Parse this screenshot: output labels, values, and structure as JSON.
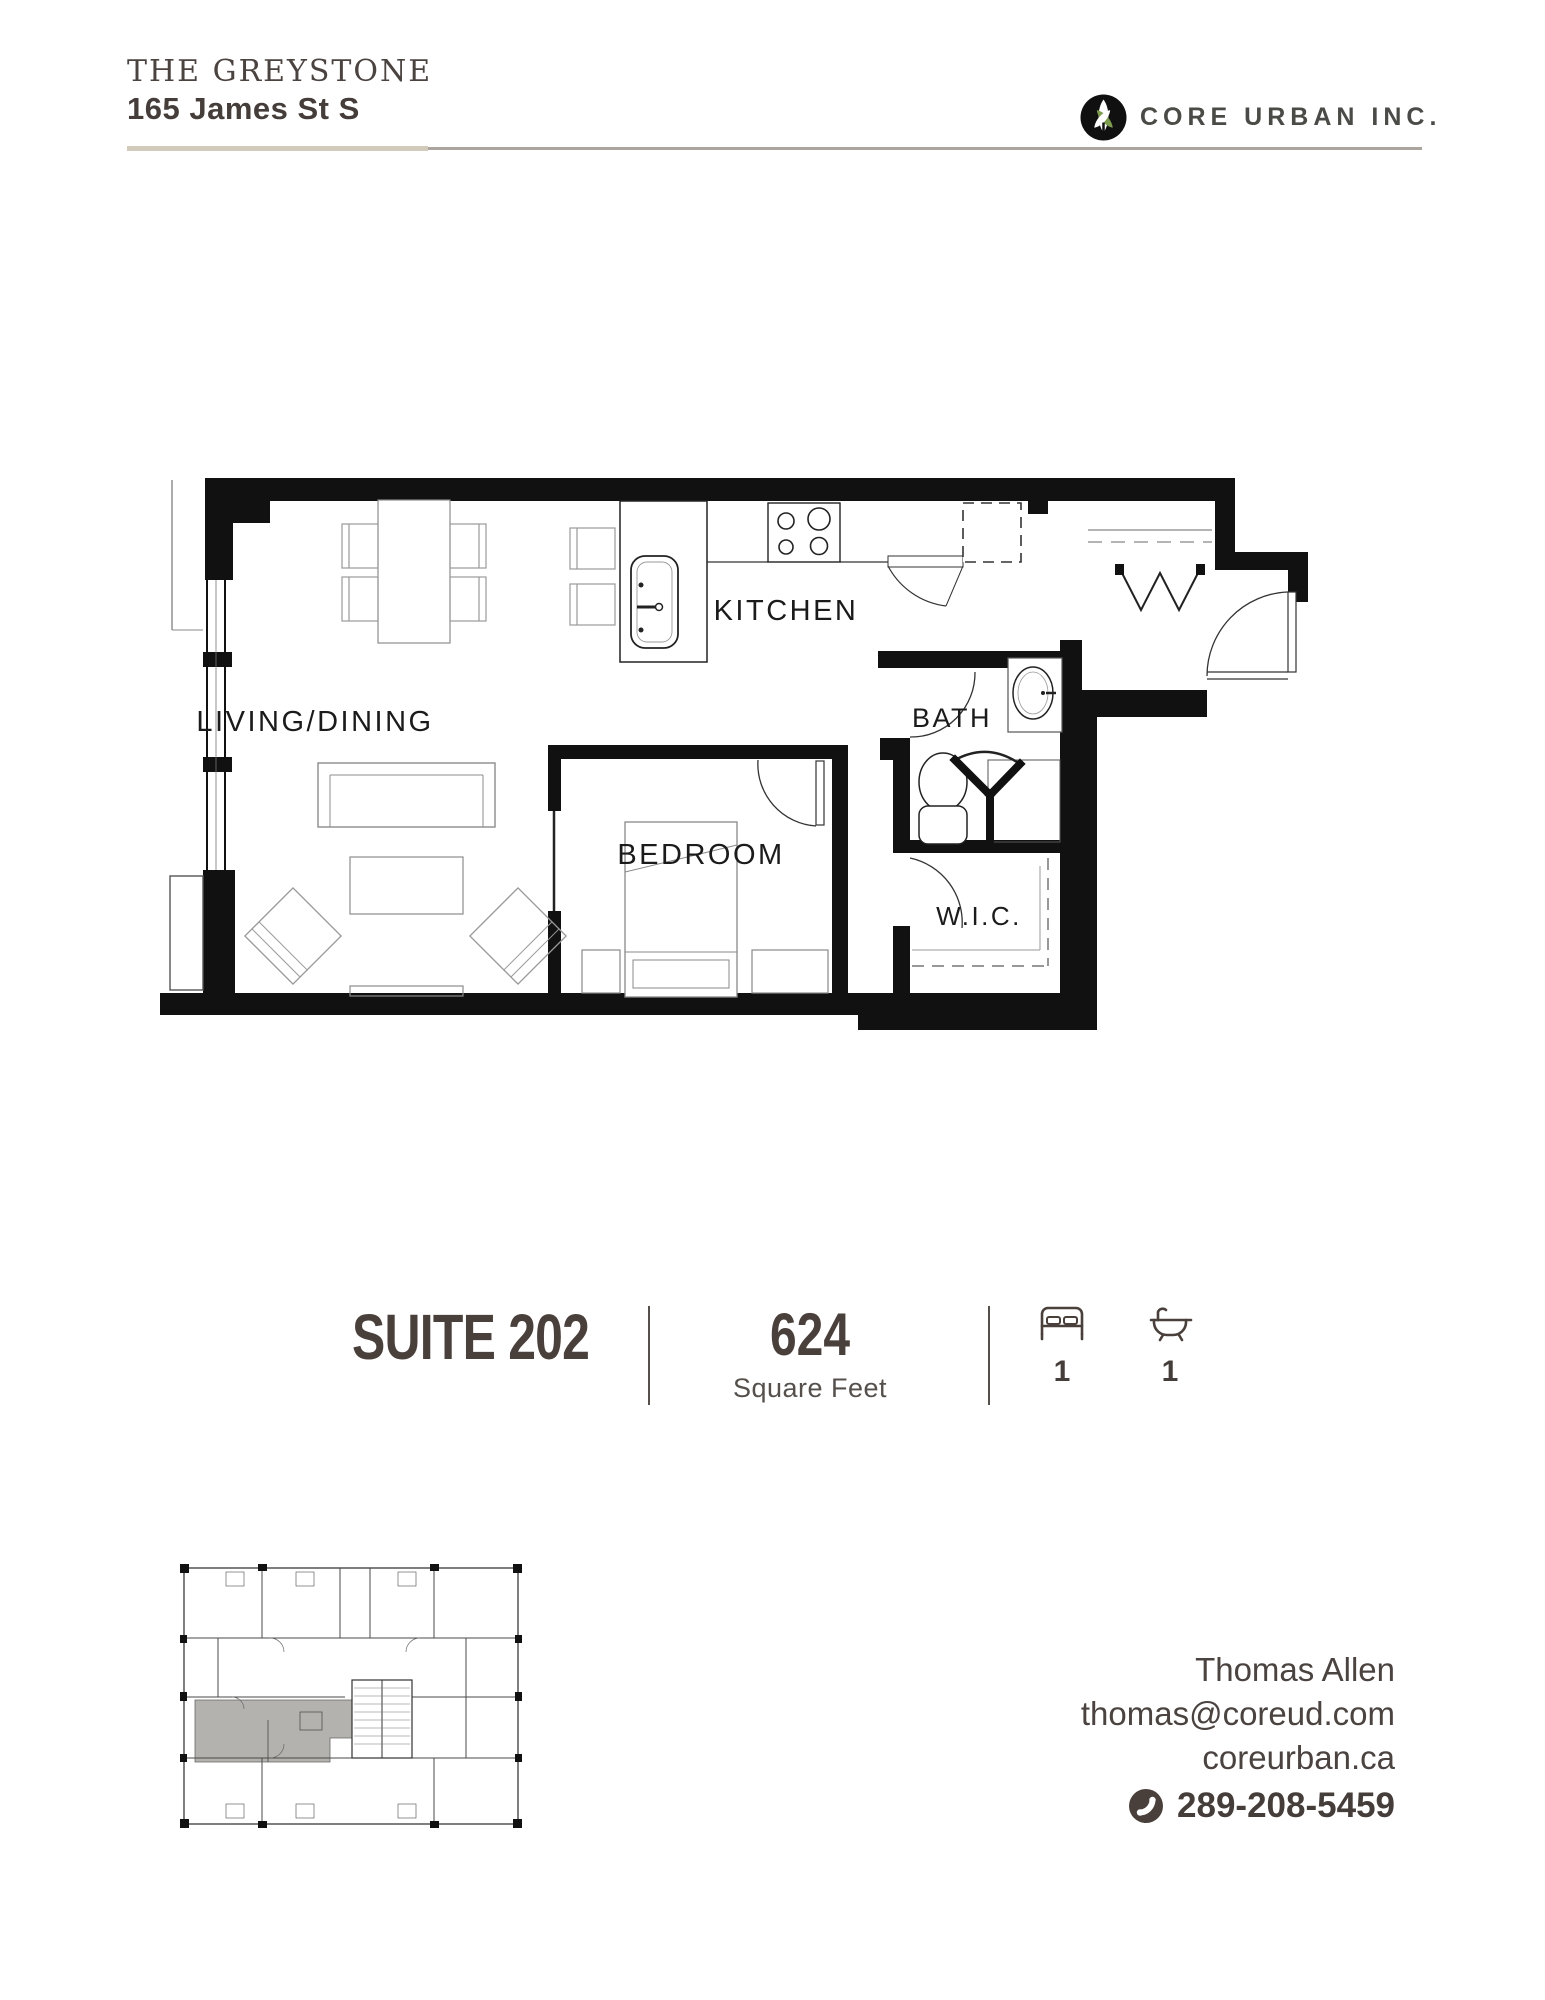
{
  "header": {
    "building_name": "THE GREYSTONE",
    "address": "165 James St S",
    "logo_text": "CORE URBAN INC.",
    "logo_icon": "leaf-sprout-icon",
    "accent_line_color": "#d2cbbb",
    "secondary_line_color": "#aca59e"
  },
  "floorplan": {
    "rooms": [
      {
        "name": "LIVING/DINING"
      },
      {
        "name": "KITCHEN"
      },
      {
        "name": "BATH"
      },
      {
        "name": "BEDROOM"
      },
      {
        "name": "W.I.C."
      }
    ]
  },
  "suite_info": {
    "suite_label": "SUITE 202",
    "area_value": "624",
    "area_unit": "Square Feet",
    "bed_icon": "bed-icon",
    "bedrooms": "1",
    "bath_icon": "bathtub-icon",
    "bathrooms": "1"
  },
  "keyplan": {
    "description": "building floor key plan with suite highlighted",
    "highlight_color": "#b3b2ae"
  },
  "contact": {
    "name": "Thomas Allen",
    "email": "thomas@coreud.com",
    "website": "coreurban.ca",
    "phone_icon": "phone-icon",
    "phone": "289-208-5459"
  },
  "colors": {
    "text_dark": "#4a403b",
    "plan_wall": "#111111",
    "furniture_line": "#8c8c8c",
    "logo_green": "#7e9c4e"
  }
}
